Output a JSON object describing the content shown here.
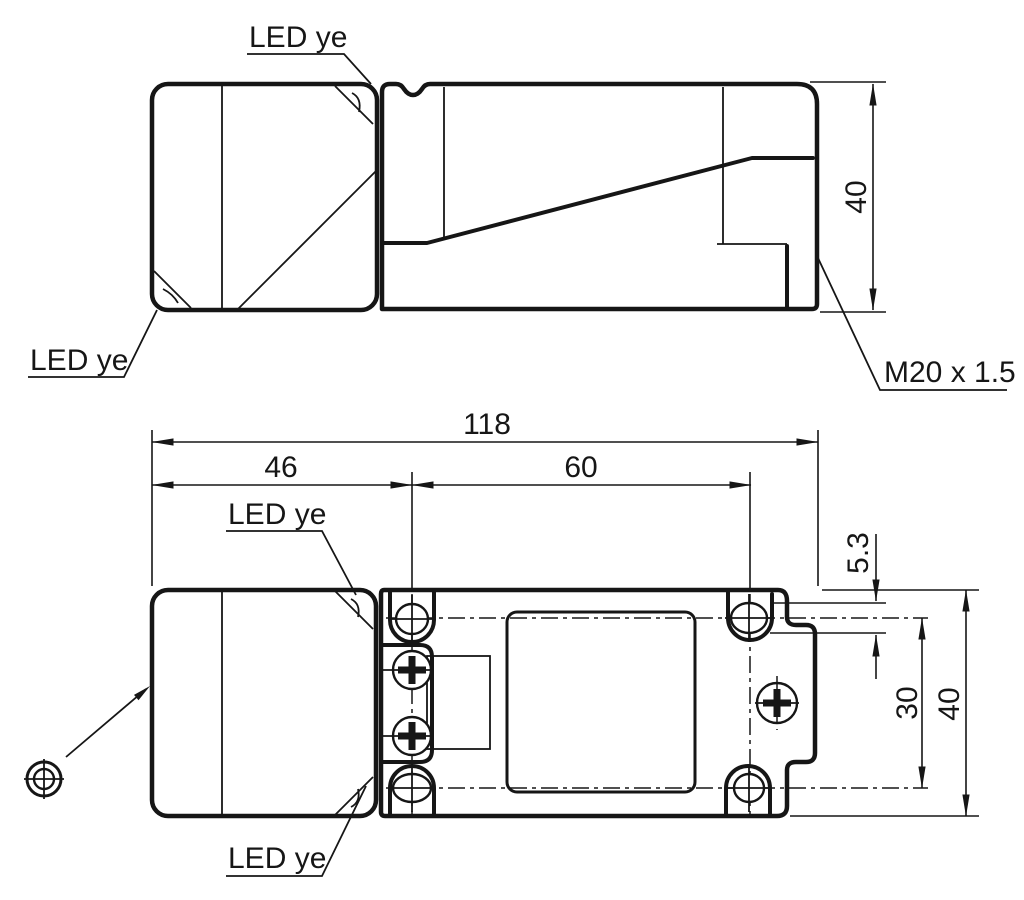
{
  "drawing": {
    "background": "#ffffff",
    "line_color": "#161616",
    "labels": {
      "led": "LED ye",
      "thread": "M20 x 1.5"
    },
    "dimensions": {
      "overall_length": "118",
      "head_length": "46",
      "hole_spacing_x": "60",
      "hole_diameter": "5.3",
      "hole_spacing_y": "30",
      "height": "40",
      "width": "40"
    }
  }
}
